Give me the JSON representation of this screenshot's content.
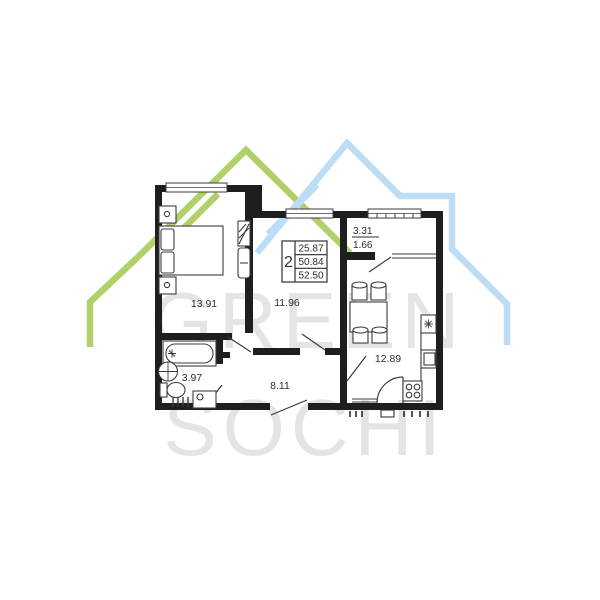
{
  "watermark": {
    "line1": "GREEN",
    "line2": "SOCHI",
    "text_color": "#e4e4e4",
    "green_house_color": "#b2d06a",
    "blue_house_color": "#bddcf5"
  },
  "info_box": {
    "rooms": "2",
    "values": [
      "25.87",
      "50.84",
      "52.50"
    ]
  },
  "rooms": {
    "bedroom": {
      "area": "13.91"
    },
    "living": {
      "area": "11.96"
    },
    "bathroom": {
      "area": "3.97"
    },
    "hallway": {
      "area": "8.11"
    },
    "kitchen": {
      "area": "12.89"
    },
    "balcony": {
      "area_total": "3.31",
      "area_reduced": "1.66"
    }
  },
  "colors": {
    "wall": "#1e1e1e",
    "thin_line": "#3c3c3c",
    "label": "#2e2e2e",
    "background": "#ffffff"
  }
}
